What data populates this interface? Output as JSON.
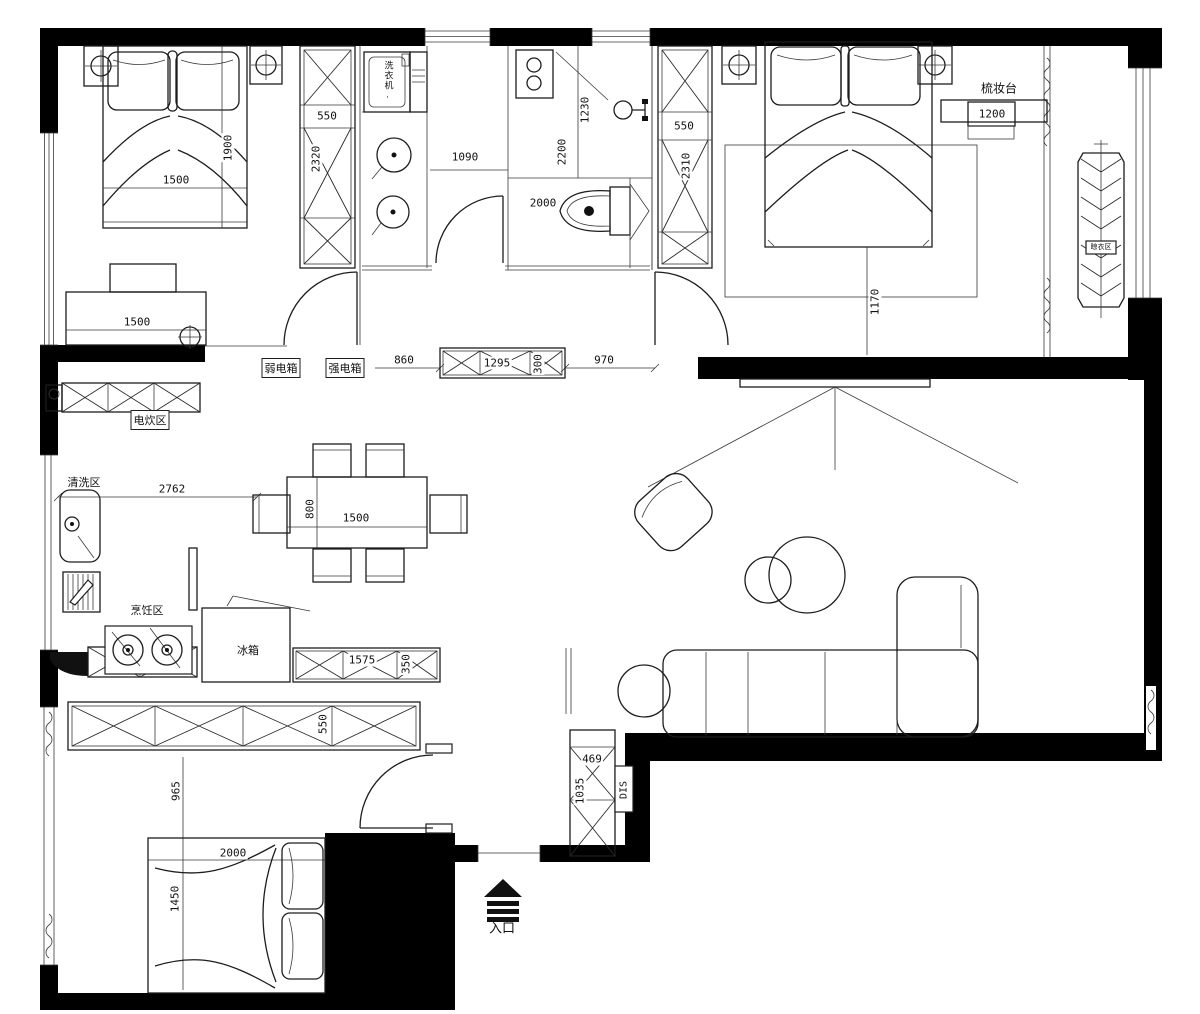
{
  "dims": {
    "bed_tl_w": "1500",
    "bed_tl_l": "1900",
    "wardrobe_tl_w": "550",
    "wardrobe_tl_h": "2320",
    "laundry_w": "1090",
    "shower_w": "1230",
    "bath_l": "2200",
    "toilet_zone": "2000",
    "wardrobe_tr_w": "550",
    "wardrobe_tr_h": "2310",
    "dresser_w": "1200",
    "bed_tr_offset": "1170",
    "desk_w": "1500",
    "hall_a": "860",
    "hall_cabinet_w": "1295",
    "hall_cabinet_d": "300",
    "hall_b": "970",
    "kitchen_w": "2762",
    "table_d": "800",
    "table_w": "1500",
    "counter_w": "1575",
    "counter_d": "350",
    "wardrobe_bl_d": "550",
    "bl_clearance": "965",
    "bed_bl_l": "2000",
    "bed_bl_w": "1450",
    "shoe_cabinet_w": "469",
    "shoe_cabinet_h": "1035"
  },
  "areas": {
    "washing_machine": "洗衣机.",
    "dresser": "梳妆台",
    "weak_current_box": "弱电箱",
    "strong_current_box": "强电箱",
    "electric_cooking_area": "电炊区",
    "washing_area": "清洗区",
    "cooking_area": "烹饪区",
    "fridge": "冰箱",
    "distribution": "DIS",
    "entrance": "入口",
    "drying_area": "晾衣区"
  }
}
